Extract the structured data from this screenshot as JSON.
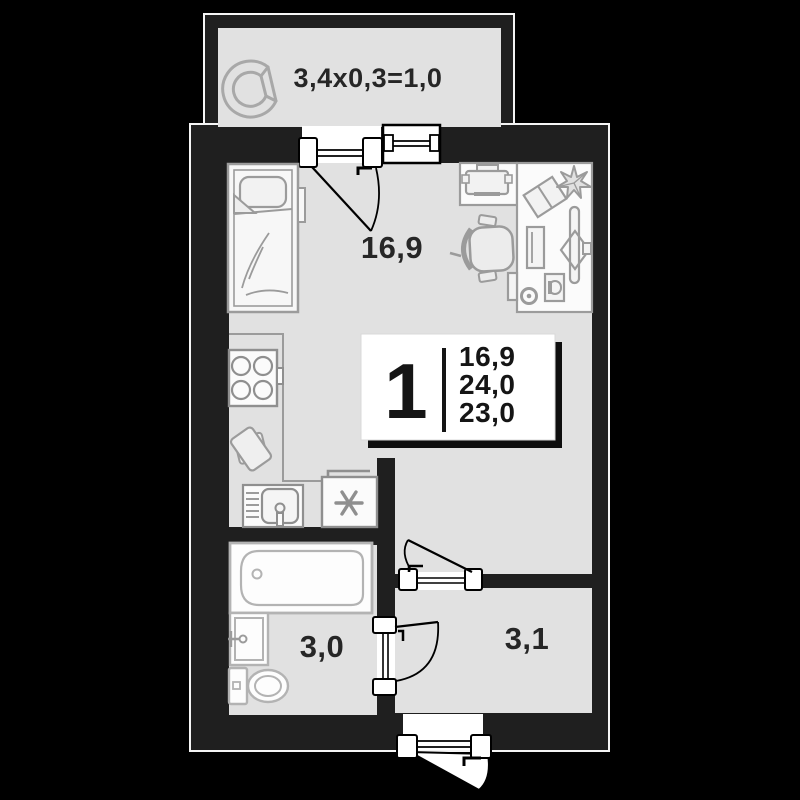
{
  "plan": {
    "badge": {
      "room_count": "1",
      "living_area": "16,9",
      "total_area": "24,0",
      "area_alt": "23,0"
    },
    "rooms": {
      "living": {
        "area": "16,9"
      },
      "bathroom": {
        "area": "3,0"
      },
      "hallway": {
        "area": "3,1"
      },
      "balcony": {
        "dimensions": "3,4x0,3=1,0"
      }
    },
    "colors": {
      "background": "#000000",
      "wall": "#1f1f1f",
      "wall_outline": "#f5f5f5",
      "floor": "#e1e1e1",
      "furniture_stroke": "#9b9b9b",
      "fixture_stroke": "#b3b3b3",
      "door_stroke": "#000000",
      "card_bg": "#ffffff",
      "card_shadow": "#0f0f0f",
      "text": "#262626"
    },
    "icons": [
      "armchair-icon",
      "bed-icon",
      "nightstand-icon",
      "printer-icon",
      "desk-icon",
      "office-chair-icon",
      "book-icon",
      "plant-icon",
      "monitor-icon",
      "keyboard-icon",
      "mug-icon",
      "notepad-icon",
      "pc-tower-icon",
      "stove-icon",
      "cutting-board-icon",
      "kitchen-sink-icon",
      "fridge-icon",
      "snowflake-icon",
      "bathtub-icon",
      "washbasin-icon",
      "toilet-icon",
      "window-icon",
      "door-icon"
    ]
  }
}
